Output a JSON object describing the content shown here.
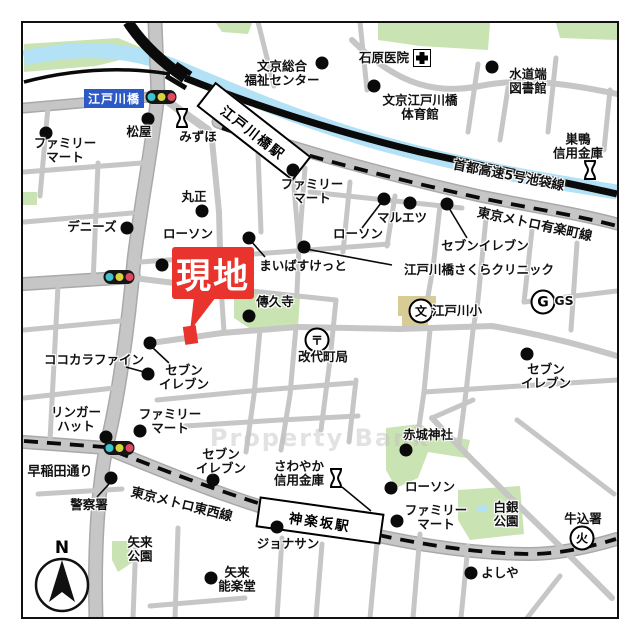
{
  "map": {
    "badge": {
      "label": "江戸川橋"
    },
    "site": {
      "label": "現地"
    },
    "watermark": "Property Bank",
    "compass": {
      "label": "N"
    },
    "stations": [
      {
        "name": "edogawabashi-station",
        "label": "江戸川橋駅",
        "x": 252,
        "y": 129,
        "w": 118,
        "h": 27,
        "rot": 38
      },
      {
        "name": "kagurazaka-station",
        "label": "神楽坂駅",
        "x": 318,
        "y": 518,
        "w": 122,
        "h": 27,
        "rot": 8
      }
    ],
    "road_labels": [
      {
        "name": "shuto-expressway-label",
        "label": "首都高速5号池袋線",
        "x": 509,
        "y": 174,
        "rot": 11
      },
      {
        "name": "yurakucho-line-label",
        "label": "東京メトロ有楽町線",
        "x": 535,
        "y": 223,
        "rot": 12
      },
      {
        "name": "tozai-line-label",
        "label": "東京メトロ東西線",
        "x": 182,
        "y": 503,
        "rot": 14
      },
      {
        "name": "waseda-dori-label",
        "label": "早稲田通り",
        "x": 60,
        "y": 470,
        "rot": 0
      }
    ],
    "traffic_lights": [
      {
        "x": 161,
        "y": 97
      },
      {
        "x": 119,
        "y": 277
      },
      {
        "x": 119,
        "y": 448
      }
    ],
    "pois": [
      {
        "name": "familymart-northwest",
        "label": "ファミリー\nマート",
        "x": 65,
        "y": 150,
        "marker": {
          "type": "dot",
          "x": 46,
          "y": 133
        }
      },
      {
        "name": "matsuya",
        "label": "松屋",
        "x": 139,
        "y": 132,
        "marker": {
          "type": "dot",
          "x": 148,
          "y": 119
        }
      },
      {
        "name": "mizuho",
        "label": "みずほ",
        "x": 198,
        "y": 137,
        "marker": {
          "type": "bank",
          "x": 182,
          "y": 120
        }
      },
      {
        "name": "bunkyo-sogo-fukushi-center",
        "label": "文京総合\n福祉センター",
        "x": 282,
        "y": 73,
        "marker": {
          "type": "dot",
          "x": 322,
          "y": 63
        }
      },
      {
        "name": "ishihara-clinic",
        "label": "石原医院",
        "x": 384,
        "y": 58,
        "marker": {
          "type": "hospital",
          "x": 422,
          "y": 58
        }
      },
      {
        "name": "suidobata-library",
        "label": "水道端\n図書館",
        "x": 528,
        "y": 81,
        "marker": {
          "type": "dot",
          "x": 492,
          "y": 67
        }
      },
      {
        "name": "bunkyo-edogawabashi-gym",
        "label": "文京江戸川橋\n体育館",
        "x": 420,
        "y": 107,
        "marker": {
          "type": "dot",
          "x": 374,
          "y": 86
        }
      },
      {
        "name": "sugamo-shinkin-bank",
        "label": "巣鴨\n信用金庫",
        "x": 578,
        "y": 146,
        "marker": {
          "type": "bank",
          "x": 590,
          "y": 172
        }
      },
      {
        "name": "familymart-north",
        "label": "ファミリー\nマート",
        "x": 312,
        "y": 191,
        "marker": {
          "type": "dot",
          "x": 293,
          "y": 170
        }
      },
      {
        "name": "marusho",
        "label": "丸正",
        "x": 194,
        "y": 197,
        "marker": {
          "type": "dot",
          "x": 202,
          "y": 211
        }
      },
      {
        "name": "dennys",
        "label": "デニーズ",
        "x": 92,
        "y": 227,
        "marker": {
          "type": "dot",
          "x": 127,
          "y": 228
        }
      },
      {
        "name": "lawson-west",
        "label": "ローソン",
        "x": 188,
        "y": 234,
        "marker": {
          "type": "dot",
          "x": 162,
          "y": 265
        }
      },
      {
        "name": "maibasuketto",
        "label": "まいばすけっと",
        "x": 303,
        "y": 266,
        "marker": {
          "type": "dot",
          "x": 249,
          "y": 238
        },
        "line": [
          251,
          241,
          265,
          257
        ]
      },
      {
        "name": "lawson-central",
        "label": "ローソン",
        "x": 358,
        "y": 234,
        "marker": {
          "type": "dot",
          "x": 384,
          "y": 199
        },
        "line": [
          362,
          228,
          381,
          203
        ]
      },
      {
        "name": "maruetsu",
        "label": "マルエツ",
        "x": 402,
        "y": 218,
        "marker": {
          "type": "dot",
          "x": 410,
          "y": 203
        }
      },
      {
        "name": "seven-eleven-northeast",
        "label": "セブンイレブン",
        "x": 485,
        "y": 246,
        "marker": {
          "type": "dot",
          "x": 447,
          "y": 204
        },
        "line": [
          449,
          208,
          467,
          238
        ]
      },
      {
        "name": "edogawabashi-sakura-clinic",
        "label": "江戸川橋さくらクリニック",
        "x": 479,
        "y": 270,
        "marker": {
          "type": "dot",
          "x": 304,
          "y": 247
        },
        "line": [
          306,
          249,
          392,
          265
        ]
      },
      {
        "name": "denkyuji-temple",
        "label": "傳久寺",
        "x": 275,
        "y": 302,
        "marker": {
          "type": "dot",
          "x": 249,
          "y": 316
        }
      },
      {
        "name": "kaitaimachi-post-office",
        "label": "改代町局",
        "x": 323,
        "y": 357,
        "marker": {
          "type": "post",
          "x": 317,
          "y": 340
        }
      },
      {
        "name": "edogawa-elementary",
        "label": "江戸川小",
        "x": 457,
        "y": 311,
        "marker": {
          "type": "school",
          "x": 421,
          "y": 311
        }
      },
      {
        "name": "gas-station",
        "label": "GS",
        "x": 564,
        "y": 301,
        "marker": {
          "type": "gs",
          "x": 543,
          "y": 302
        }
      },
      {
        "name": "seven-eleven-east",
        "label": "セブン\nイレブン",
        "x": 546,
        "y": 376,
        "marker": {
          "type": "dot",
          "x": 527,
          "y": 354
        }
      },
      {
        "name": "cocokara-fine",
        "label": "ココカラファイン",
        "x": 94,
        "y": 360,
        "marker": {
          "type": "dot",
          "x": 148,
          "y": 374
        },
        "line": [
          126,
          367,
          144,
          372
        ]
      },
      {
        "name": "seven-eleven-central",
        "label": "セブン\nイレブン",
        "x": 184,
        "y": 377,
        "marker": {
          "type": "dot",
          "x": 150,
          "y": 343
        },
        "line": [
          153,
          348,
          169,
          363
        ]
      },
      {
        "name": "ringer-hut",
        "label": "リンガー\nハット",
        "x": 76,
        "y": 419,
        "marker": {
          "type": "dot",
          "x": 106,
          "y": 437
        }
      },
      {
        "name": "familymart-central",
        "label": "ファミリー\nマート",
        "x": 170,
        "y": 421,
        "marker": {
          "type": "dot",
          "x": 140,
          "y": 431
        }
      },
      {
        "name": "police-station",
        "label": "警察署",
        "x": 89,
        "y": 505,
        "marker": {
          "type": "dot",
          "x": 111,
          "y": 478
        },
        "line": [
          97,
          497,
          109,
          484
        ]
      },
      {
        "name": "seven-eleven-south",
        "label": "セブン\nイレブン",
        "x": 221,
        "y": 461,
        "marker": {
          "type": "dot",
          "x": 213,
          "y": 480
        }
      },
      {
        "name": "sawayaka-shinkin-bank",
        "label": "さわやか\n信用金庫",
        "x": 299,
        "y": 473,
        "marker": {
          "type": "bank",
          "x": 336,
          "y": 480
        },
        "line": [
          342,
          487,
          371,
          511
        ]
      },
      {
        "name": "lawson-south",
        "label": "ローソン",
        "x": 430,
        "y": 487,
        "marker": {
          "type": "dot",
          "x": 391,
          "y": 488
        }
      },
      {
        "name": "familymart-south",
        "label": "ファミリー\nマート",
        "x": 436,
        "y": 517,
        "marker": {
          "type": "dot",
          "x": 397,
          "y": 521
        }
      },
      {
        "name": "akagi-shrine",
        "label": "赤城神社",
        "x": 428,
        "y": 435,
        "marker": {
          "type": "dot",
          "x": 406,
          "y": 450
        }
      },
      {
        "name": "shirogane-park",
        "label": "白銀\n公園",
        "x": 506,
        "y": 514
      },
      {
        "name": "ushigome-fire-station",
        "label": "牛込署",
        "x": 583,
        "y": 519,
        "marker": {
          "type": "fire",
          "x": 582,
          "y": 538
        }
      },
      {
        "name": "yoshiya",
        "label": "よしや",
        "x": 500,
        "y": 573,
        "marker": {
          "type": "dot",
          "x": 471,
          "y": 573
        }
      },
      {
        "name": "jonathans",
        "label": "ジョナサン",
        "x": 288,
        "y": 544,
        "marker": {
          "type": "dot",
          "x": 277,
          "y": 527
        }
      },
      {
        "name": "yarai-park",
        "label": "矢来\n公園",
        "x": 140,
        "y": 549
      },
      {
        "name": "yarai-noh-theater",
        "label": "矢来\n能楽堂",
        "x": 237,
        "y": 579,
        "marker": {
          "type": "dot",
          "x": 211,
          "y": 578
        }
      }
    ]
  },
  "colors": {
    "site_red": "#e8342c",
    "badge_blue": "#2d59c7",
    "river": "#b3e1f5",
    "park_green": "#c9e3b2",
    "road_gray": "#c6c6c6",
    "school_tan": "#d8cc96",
    "signal_cyan": "#3fc3cf",
    "signal_yellow": "#d9d43e",
    "signal_red": "#df4a5e"
  }
}
